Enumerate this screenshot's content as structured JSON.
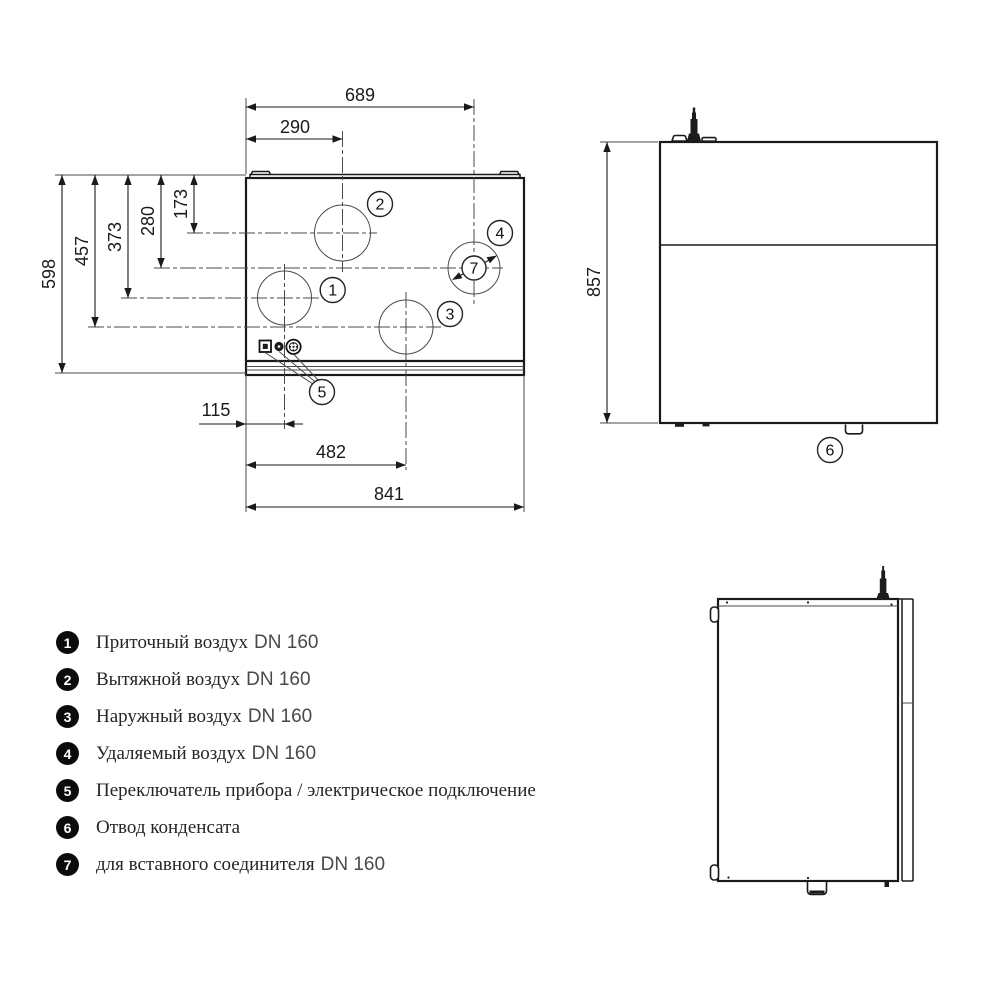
{
  "front_view": {
    "dimensions": {
      "top_width": "689",
      "supply_x": "290",
      "height_full": "598",
      "h_457": "457",
      "h_373": "373",
      "h_280": "280",
      "h_173": "173",
      "switch_x": "115",
      "outdoor_x": "482",
      "width_full": "841"
    },
    "callouts": {
      "c1": "1",
      "c2": "2",
      "c3": "3",
      "c4": "4",
      "c5": "5",
      "c7": "7"
    }
  },
  "side_view": {
    "height": "857",
    "callout_drain": "6"
  },
  "legend": {
    "items": [
      {
        "num": "1",
        "text": "Приточный воздух",
        "dn": "DN 160"
      },
      {
        "num": "2",
        "text": "Вытяжной воздух",
        "dn": "DN 160"
      },
      {
        "num": "3",
        "text": "Наружный воздух",
        "dn": "DN 160"
      },
      {
        "num": "4",
        "text": "Удаляемый воздух",
        "dn": "DN 160"
      },
      {
        "num": "5",
        "text": "Переключатель прибора / электрическое подключение",
        "dn": ""
      },
      {
        "num": "6",
        "text": "Отвод конденсата",
        "dn": ""
      },
      {
        "num": "7",
        "text": "для вставного соединителя",
        "dn": "DN 160"
      }
    ]
  }
}
